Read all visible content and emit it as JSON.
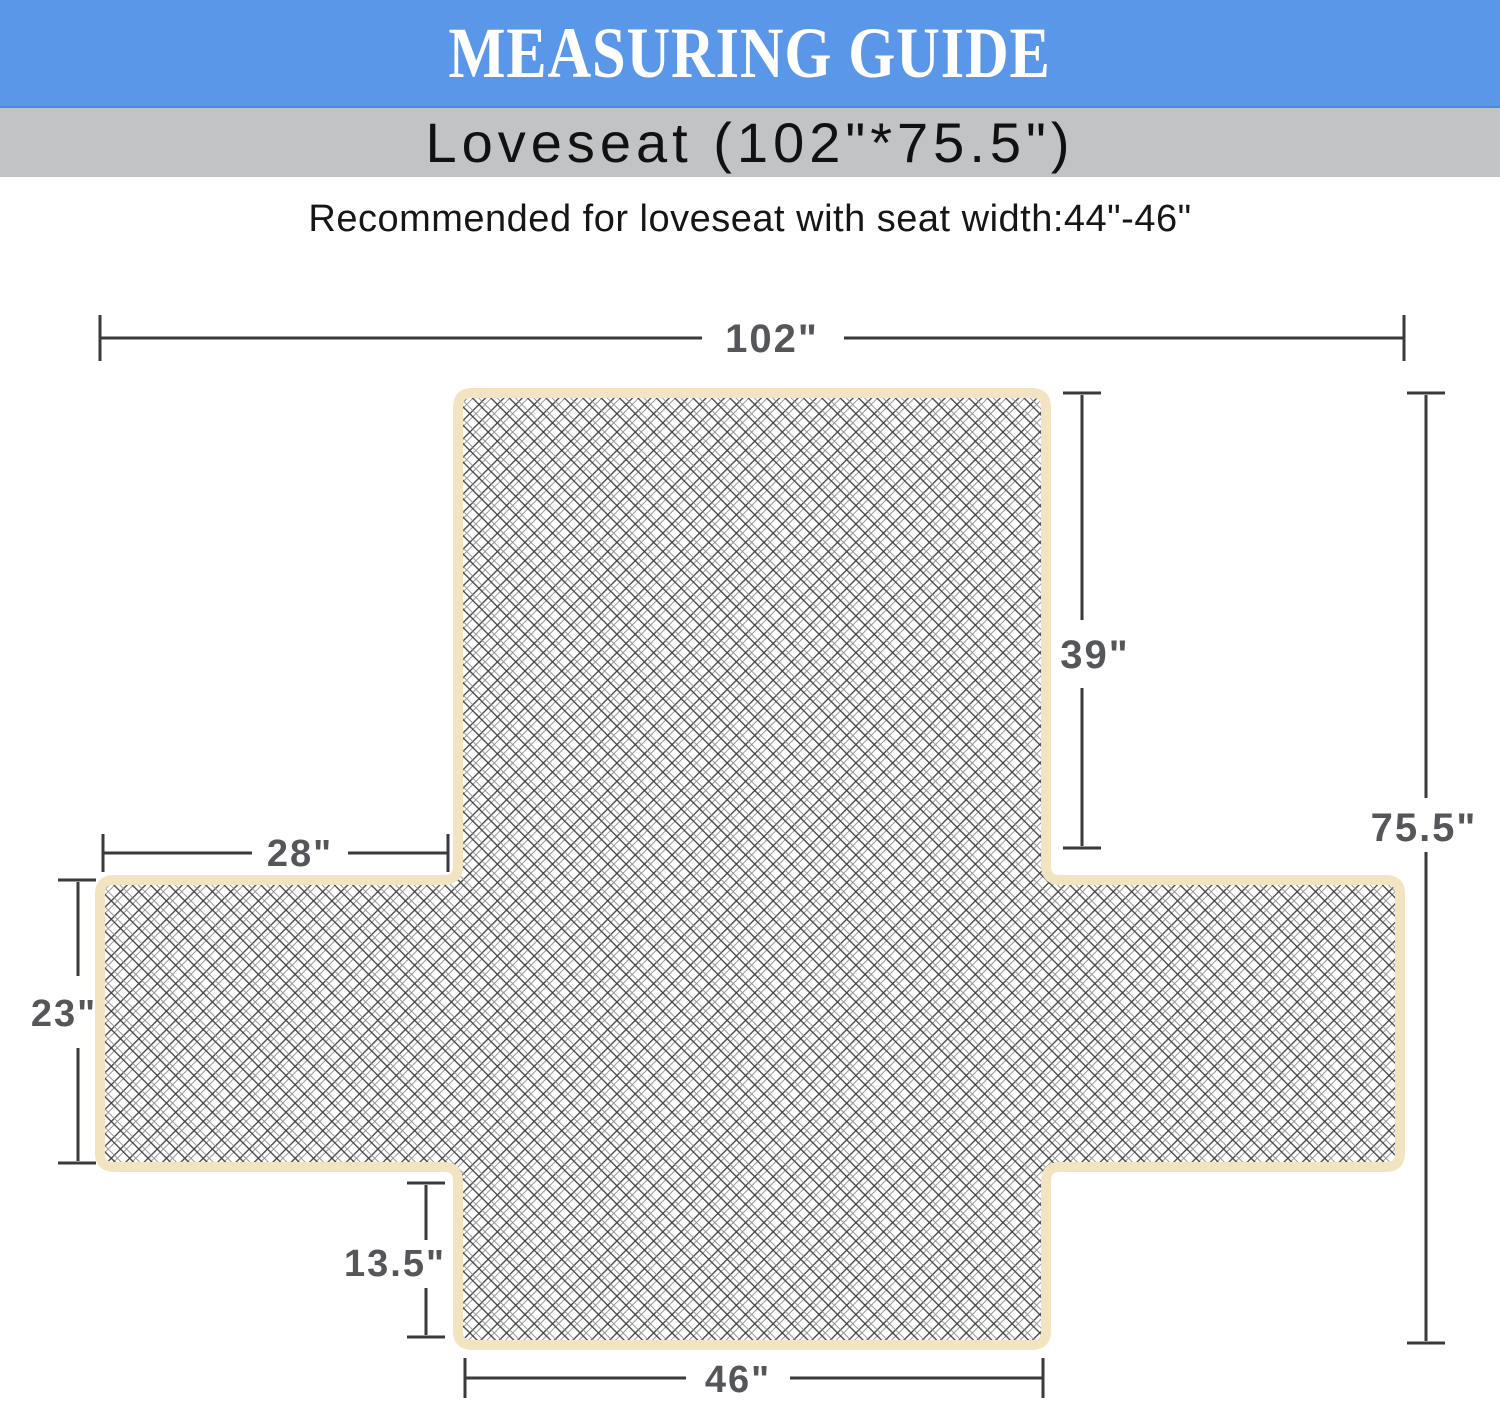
{
  "header": {
    "title": "MEASURING GUIDE",
    "background": "#5b97e8",
    "text_color": "#ffffff"
  },
  "subheader": {
    "label": "Loveseat (102\"*75.5\")",
    "background": "#c2c3c5",
    "text_color": "#111111"
  },
  "note": "Recommended for loveseat with seat width:44\"-46\"",
  "diagram": {
    "cover_border_color": "#f2e3c1",
    "cover_fill_color": "#ffffff",
    "hatch_primary_color": "#3f3f41",
    "hatch_secondary_color": "#8f8f91",
    "dimension_line_color": "#3a3a3c",
    "dimension_label_color": "#55565a",
    "dimensions": {
      "overall_width": "102\"",
      "back_height": "39\"",
      "overall_depth": "75.5\"",
      "arm_width": "28\"",
      "arm_depth": "23\"",
      "front_skirt_length": "13.5\"",
      "seat_width": "46\""
    }
  }
}
